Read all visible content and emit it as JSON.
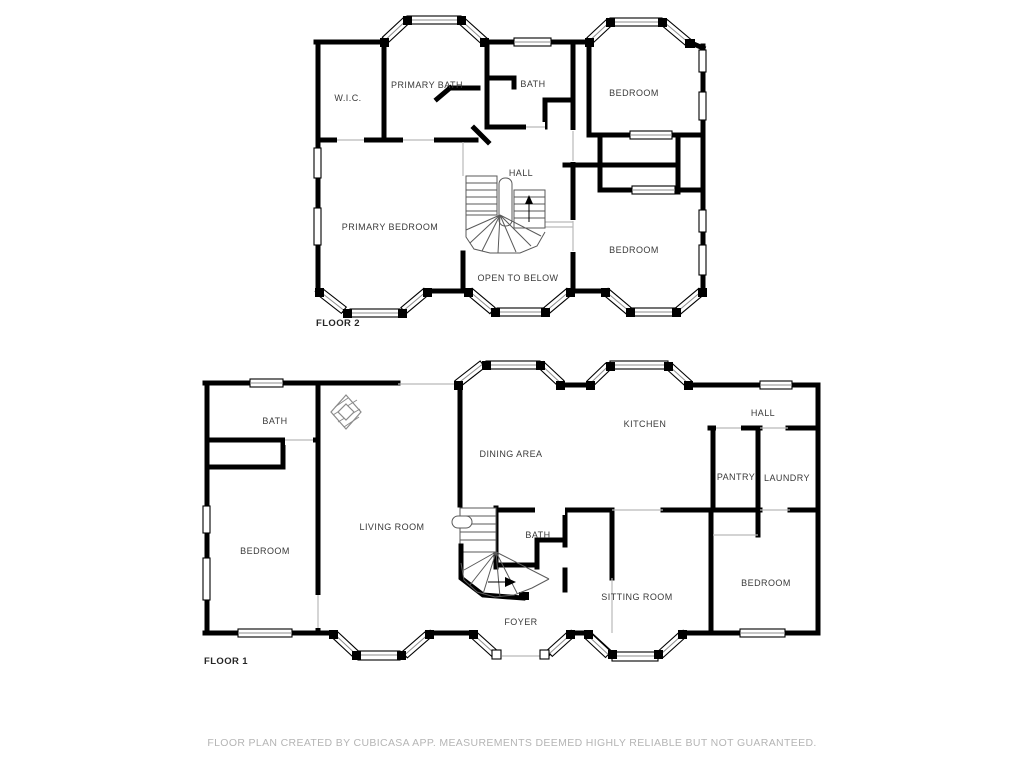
{
  "floor2": {
    "name": "FLOOR 2",
    "rooms": {
      "wic": "W.I.C.",
      "primary_bath": "PRIMARY BATH",
      "bath": "BATH",
      "bedroom_tr": "BEDROOM",
      "hall": "HALL",
      "primary_bedroom": "PRIMARY BEDROOM",
      "bedroom_br": "BEDROOM",
      "open_to_below": "OPEN TO BELOW"
    }
  },
  "floor1": {
    "name": "FLOOR 1",
    "rooms": {
      "bath_upper": "BATH",
      "dining": "DINING AREA",
      "kitchen": "KITCHEN",
      "hall": "HALL",
      "pantry": "PANTRY",
      "laundry": "LAUNDRY",
      "bedroom_left": "BEDROOM",
      "living": "LIVING ROOM",
      "bath_center": "BATH",
      "sitting": "SITTING ROOM",
      "bedroom_right": "BEDROOM",
      "foyer": "FOYER"
    }
  },
  "footer": {
    "disclaimer": "FLOOR PLAN CREATED BY CUBICASA APP. MEASUREMENTS DEEMED HIGHLY RELIABLE BUT NOT GUARANTEED."
  },
  "colors": {
    "wall": "#000000",
    "label": "#3a3a3a",
    "muted": "#b5b5b5"
  }
}
